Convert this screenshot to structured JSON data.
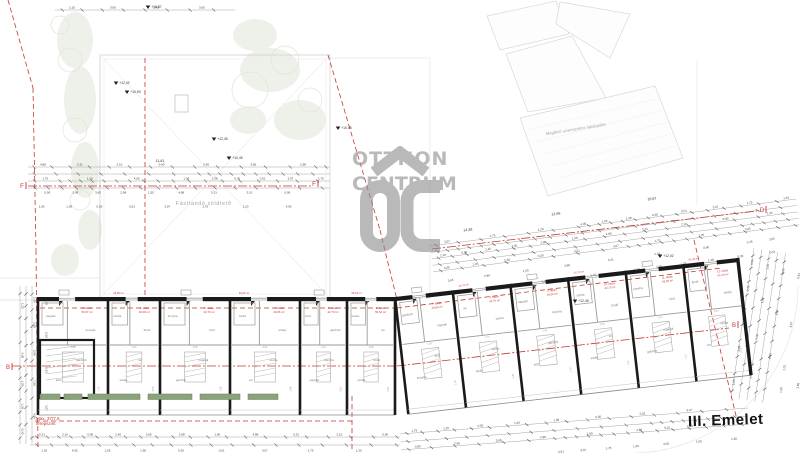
{
  "floor_label": "III. Emelet",
  "watermark": {
    "line1": "OTTHON",
    "line2": "CENTRUM"
  },
  "labels": {
    "neighbor": "Meglévő szomszédos lakóépület",
    "terrace": "Fásítandó zöldtető",
    "note1": "Max. 37/7,5",
    "note2": "terepszint"
  },
  "colors": {
    "red": "#c4372f",
    "watermark": "#b5b5b5",
    "planter_green": "#8ba37d",
    "planter_edge": "#66804f",
    "wall": "#1a1a1a"
  },
  "section_markers": [
    {
      "letter": "F",
      "x": 22,
      "y": 188
    },
    {
      "letter": "F",
      "x": 314,
      "y": 186
    },
    {
      "letter": "D",
      "x": 762,
      "y": 212
    },
    {
      "letter": "B",
      "x": 8,
      "y": 369
    },
    {
      "letter": "B",
      "x": 734,
      "y": 327
    }
  ],
  "elevation_marks": [
    {
      "label": "+12,02",
      "x": 116,
      "y": 85
    },
    {
      "label": "+10,90",
      "x": 127,
      "y": 94
    },
    {
      "label": "+12,45",
      "x": 214,
      "y": 141
    },
    {
      "label": "+10,45",
      "x": 229,
      "y": 160
    },
    {
      "label": "+16,87",
      "x": 148,
      "y": 9
    },
    {
      "label": "+12,45",
      "x": 575,
      "y": 303
    },
    {
      "label": "+10,45",
      "x": 338,
      "y": 130
    },
    {
      "label": "+12,02",
      "x": 660,
      "y": 258
    }
  ],
  "span_dims": [
    {
      "t": "11,61",
      "x": 160,
      "y": 162,
      "r": 0
    },
    {
      "t": "14,38",
      "x": 468,
      "y": 231,
      "r": -7
    },
    {
      "t": "12,99",
      "x": 556,
      "y": 215,
      "r": -7
    },
    {
      "t": "16,87",
      "x": 652,
      "y": 200,
      "r": -7
    }
  ],
  "dims_pool": [
    "0,51",
    "4,88",
    "3,07",
    "5,31",
    "1,75",
    "2,10",
    "1,20",
    "0,90",
    "4,05",
    "2,45",
    "1,05",
    "3,65",
    "1,38",
    "2,98",
    "0,30",
    "1,50"
  ],
  "rooms_pool": [
    "nappali",
    "szoba",
    "konyha",
    "fürdő",
    "közl.",
    "erkély",
    "gardrób",
    "wc"
  ],
  "apartments": [
    {
      "label": "1. lakás",
      "area": "53,97 m²"
    },
    {
      "label": "2. lakás",
      "area": "49,06 m²"
    },
    {
      "label": "3. lakás",
      "area": "42,70 m²"
    },
    {
      "label": "4. lakás",
      "area": "49,06 m²"
    },
    {
      "label": "5. lakás",
      "area": "42,70 m²"
    },
    {
      "label": "6. lakás",
      "area": "56,64 m²"
    },
    {
      "label": "7. lakás",
      "area": "49,06 m²"
    },
    {
      "label": "8. lakás",
      "area": "42,70 m²"
    },
    {
      "label": "9. lakás",
      "area": "49,06 m²"
    },
    {
      "label": "10. lakás",
      "area": "42,70 m²"
    },
    {
      "label": "11. lakás",
      "area": "49,06 m²"
    },
    {
      "label": "12. lakás",
      "area": "61,20 m²"
    }
  ]
}
